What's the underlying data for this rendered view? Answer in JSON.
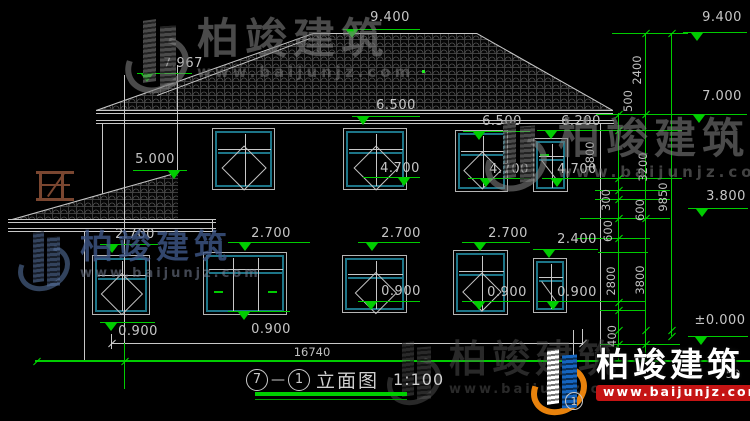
{
  "brand": {
    "name": "柏竣建筑",
    "url": "www.baijunjz.com"
  },
  "title_block": {
    "axis_from": "7",
    "separator": "—",
    "axis_to": "1",
    "title": "立面图",
    "scale": "1:100"
  },
  "colors": {
    "line": "#c8c8c8",
    "dim_green": "#00cc00",
    "teal_window": "#1d7588",
    "wood_brown": "#7a4630",
    "logo_blue": "#1565c0",
    "logo_orange": "#e8820c",
    "url_red": "#c51414"
  },
  "drawing": {
    "levels": [
      {
        "t": "9.400",
        "x": 390,
        "y": 18,
        "l": [
          343,
          420,
          29
        ],
        "a": 352
      },
      {
        "t": "9.400",
        "x": 722,
        "y": 18,
        "l": [
          683,
          747,
          32
        ],
        "a": 697
      },
      {
        "t": "7.967",
        "x": 183,
        "y": 64,
        "l": [
          137,
          192,
          73
        ],
        "a": 147
      },
      {
        "t": "7.000",
        "x": 722,
        "y": 97,
        "l": [
          683,
          747,
          114
        ],
        "a": 699
      },
      {
        "t": "6.500",
        "x": 396,
        "y": 106,
        "l": [
          352,
          420,
          116
        ],
        "a": 363
      },
      {
        "t": "6.500",
        "x": 502,
        "y": 122,
        "l": [
          463,
          530,
          131
        ],
        "a": 479
      },
      {
        "t": "6.200",
        "x": 581,
        "y": 122,
        "l": [
          537,
          608,
          130
        ],
        "a": 551
      },
      {
        "t": "5.000",
        "x": 155,
        "y": 160,
        "l": [
          133,
          187,
          170
        ],
        "a": 174
      },
      {
        "t": "4.700",
        "x": 400,
        "y": 169,
        "l": [
          363,
          420,
          177
        ],
        "a": 404
      },
      {
        "t": "4.700",
        "x": 509,
        "y": 170,
        "l": [
          468,
          530,
          178
        ],
        "a": 486
      },
      {
        "t": "4.700",
        "x": 577,
        "y": 170,
        "l": [
          542,
          600,
          178
        ],
        "a": 557
      },
      {
        "t": "2.700",
        "x": 135,
        "y": 235,
        "l": [
          100,
          158,
          244
        ],
        "a": 112
      },
      {
        "t": "2.700",
        "x": 271,
        "y": 234,
        "l": [
          228,
          310,
          242
        ],
        "a": 245
      },
      {
        "t": "2.700",
        "x": 401,
        "y": 234,
        "l": [
          358,
          420,
          242
        ],
        "a": 372
      },
      {
        "t": "2.700",
        "x": 508,
        "y": 234,
        "l": [
          462,
          530,
          242
        ],
        "a": 480
      },
      {
        "t": "2.400",
        "x": 577,
        "y": 240,
        "l": [
          533,
          598,
          249
        ],
        "a": 549
      },
      {
        "t": "0.900",
        "x": 138,
        "y": 332,
        "l": [
          100,
          155,
          322
        ],
        "a": 111,
        "b": 1
      },
      {
        "t": "0.900",
        "x": 271,
        "y": 330,
        "l": [
          228,
          290,
          311
        ],
        "a": 244,
        "b": 1
      },
      {
        "t": "0.900",
        "x": 401,
        "y": 292,
        "l": [
          358,
          420,
          301
        ],
        "a": 371
      },
      {
        "t": "0.900",
        "x": 507,
        "y": 293,
        "l": [
          462,
          530,
          301
        ],
        "a": 479
      },
      {
        "t": "0.900",
        "x": 577,
        "y": 293,
        "l": [
          538,
          598,
          301
        ],
        "a": 553
      },
      {
        "t": "3.800",
        "x": 726,
        "y": 197,
        "l": [
          688,
          748,
          208
        ],
        "a": 702
      },
      {
        "t": "±0.000",
        "x": 720,
        "y": 321,
        "l": [
          688,
          748,
          336
        ],
        "a": 701
      }
    ],
    "vdims": [
      [
        "2400",
        637,
        70
      ],
      [
        "500",
        628,
        101
      ],
      [
        "1800",
        590,
        156
      ],
      [
        "3200",
        643,
        167
      ],
      [
        "300",
        606,
        200
      ],
      [
        "600",
        640,
        210
      ],
      [
        "600",
        608,
        231
      ],
      [
        "2800",
        611,
        281
      ],
      [
        "3800",
        640,
        280
      ],
      [
        "9850",
        663,
        197
      ],
      [
        "400",
        612,
        336
      ]
    ],
    "hdims": [
      [
        "16740",
        312,
        352
      ],
      [
        "50",
        733,
        374
      ]
    ],
    "roofs": [
      {
        "x": 96,
        "y": 33,
        "w": 517,
        "h": 77,
        "clip": "0px 77px, 217px 0px, 381px 0px, 517px 77px"
      },
      {
        "x": 12,
        "y": 172,
        "w": 166,
        "h": 47,
        "clip": "0px 47px, 166px 0px, 166px 47px",
        "late": 1
      }
    ],
    "lines": [
      [
        313,
        33,
        164,
        0,
        "w"
      ],
      [
        96,
        110,
        230.3,
        -19.53,
        "w"
      ],
      [
        477,
        33,
        156.4,
        29.51,
        "w"
      ],
      [
        157,
        95,
        163.3,
        -20.44,
        "w"
      ],
      [
        96,
        110,
        517,
        0,
        "w"
      ],
      [
        96,
        113,
        517,
        0,
        "w"
      ],
      [
        96,
        120,
        518,
        0,
        "w"
      ],
      [
        96,
        123,
        518,
        0,
        "w"
      ],
      [
        103,
        123,
        97,
        90,
        "w"
      ],
      [
        85,
        231,
        130,
        90,
        "w"
      ],
      [
        601,
        123,
        238,
        90,
        "w"
      ],
      [
        178,
        65,
        107,
        90,
        "w"
      ],
      [
        112,
        343,
        471,
        0,
        "w"
      ],
      [
        112,
        334,
        15,
        90,
        "w"
      ],
      [
        583,
        329,
        16,
        90,
        "w"
      ],
      [
        574,
        330,
        63,
        90,
        "w"
      ],
      [
        234,
        284,
        9,
        -50,
        "w"
      ],
      [
        239,
        287,
        9,
        -50,
        "w"
      ],
      [
        35,
        360,
        715,
        0,
        "g",
        2
      ],
      [
        619,
        113,
        248,
        90,
        "g"
      ],
      [
        646,
        33,
        328,
        90,
        "g"
      ],
      [
        672,
        33,
        303,
        90,
        "g"
      ],
      [
        612,
        33,
        76,
        0,
        "g"
      ],
      [
        596,
        114,
        90,
        0,
        "g"
      ],
      [
        593,
        130,
        89,
        0,
        "g"
      ],
      [
        593,
        178,
        89,
        0,
        "g"
      ],
      [
        595,
        190,
        75,
        0,
        "g"
      ],
      [
        595,
        199,
        75,
        0,
        "g"
      ],
      [
        580,
        218,
        90,
        0,
        "g"
      ],
      [
        577,
        238,
        73,
        0,
        "g"
      ],
      [
        598,
        252,
        50,
        0,
        "g"
      ],
      [
        598,
        301,
        48,
        0,
        "g"
      ],
      [
        600,
        310,
        46,
        0,
        "g"
      ],
      [
        600,
        344,
        80,
        0,
        "g"
      ],
      [
        125,
        343,
        46,
        90,
        "g"
      ]
    ],
    "lines2": [
      [
        12,
        219,
        172.5,
        -15.8,
        "w"
      ],
      [
        8,
        219,
        208,
        0,
        "w"
      ],
      [
        8,
        222,
        208,
        0,
        "w"
      ],
      [
        8,
        228,
        208,
        0,
        "w"
      ],
      [
        8,
        231,
        208,
        0,
        "w"
      ],
      [
        213,
        219,
        12,
        90,
        "w"
      ],
      [
        125,
        75,
        268,
        90,
        "w"
      ],
      [
        36,
        171,
        38,
        0,
        "b",
        3
      ],
      [
        40,
        184,
        30,
        0,
        "b",
        2
      ],
      [
        36,
        198,
        38,
        0,
        "b",
        3
      ],
      [
        42,
        171,
        30,
        90,
        "b",
        3
      ],
      [
        64,
        171,
        30,
        90,
        "b",
        3
      ],
      [
        47,
        196,
        28,
        -55,
        "b",
        2
      ]
    ],
    "ticks": [
      [
        646,
        33,
        "g"
      ],
      [
        672,
        33,
        "g"
      ],
      [
        619,
        114,
        "g"
      ],
      [
        646,
        114,
        "g"
      ],
      [
        619,
        130,
        "g"
      ],
      [
        619,
        178,
        "g"
      ],
      [
        619,
        190,
        "g"
      ],
      [
        619,
        199,
        "g"
      ],
      [
        619,
        218,
        "g"
      ],
      [
        646,
        218,
        "g"
      ],
      [
        619,
        238,
        "g"
      ],
      [
        619,
        302,
        "g"
      ],
      [
        619,
        310,
        "g"
      ],
      [
        619,
        330,
        "g"
      ],
      [
        646,
        330,
        "g"
      ],
      [
        672,
        330,
        "g"
      ],
      [
        672,
        336,
        "g"
      ],
      [
        619,
        344,
        "g"
      ],
      [
        646,
        344,
        "g"
      ],
      [
        125,
        361,
        "g"
      ],
      [
        37,
        361,
        "g"
      ],
      [
        112,
        343,
        "w"
      ],
      [
        583,
        343,
        "w"
      ]
    ],
    "dot": [
      422,
      70
    ],
    "windows": [
      {
        "x": 212,
        "y": 128,
        "w": 63,
        "h": 62,
        "t": "c2"
      },
      {
        "x": 343,
        "y": 128,
        "w": 64,
        "h": 62,
        "t": "c2"
      },
      {
        "x": 455,
        "y": 130,
        "w": 53,
        "h": 62,
        "t": "c2"
      },
      {
        "x": 533,
        "y": 138,
        "w": 35,
        "h": 54,
        "t": "n"
      },
      {
        "x": 92,
        "y": 255,
        "w": 58,
        "h": 60,
        "t": "c2"
      },
      {
        "x": 203,
        "y": 252,
        "w": 84,
        "h": 63,
        "t": "s3"
      },
      {
        "x": 342,
        "y": 255,
        "w": 65,
        "h": 58,
        "t": "c2"
      },
      {
        "x": 453,
        "y": 250,
        "w": 55,
        "h": 65,
        "t": "c2"
      },
      {
        "x": 533,
        "y": 258,
        "w": 34,
        "h": 55,
        "t": "n"
      }
    ],
    "green_dashes": [
      [
        214,
        291
      ],
      [
        268,
        291
      ],
      [
        540,
        154
      ]
    ]
  }
}
